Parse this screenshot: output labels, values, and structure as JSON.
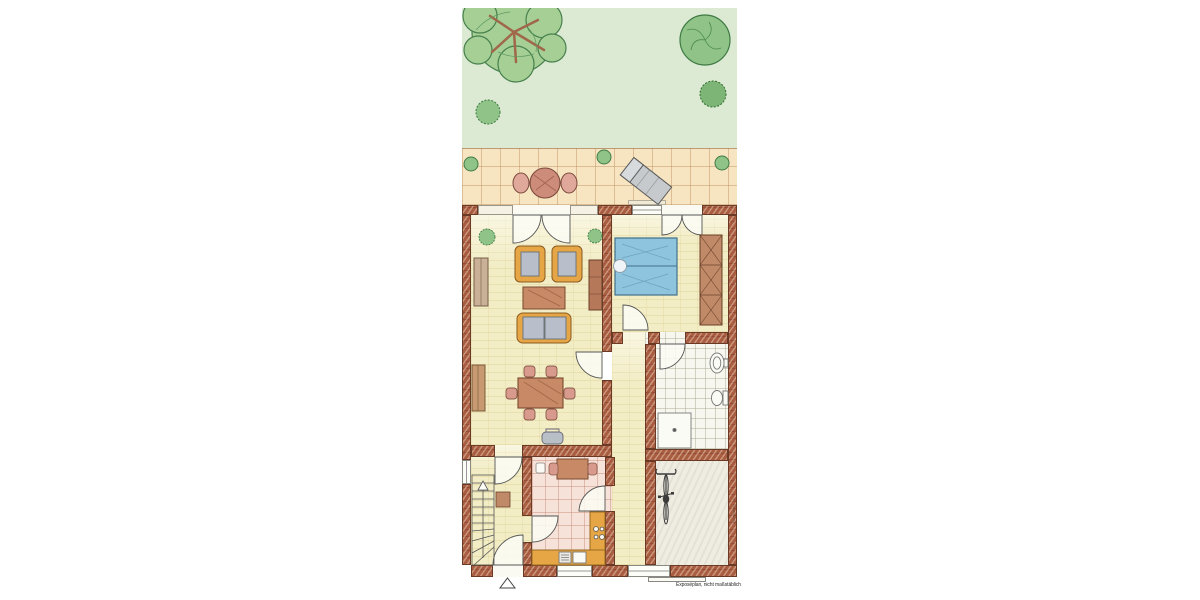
{
  "annotation": {
    "footer_note": "Exposéplan, nicht maßstäblich",
    "watermark": "© Grundriss"
  },
  "colors": {
    "wall_brick": "#a85c40",
    "floor_living": "#f2edc5",
    "floor_tile": "#f8f7ef",
    "floor_kitchen": "#f6e2d8",
    "floor_bike": "#efece2",
    "terrace": "#f7e5c2",
    "garden": "#dcead3",
    "bed_blue": "#8ec4de",
    "furniture_orange": "#e6a645",
    "furniture_wood": "#c88a66",
    "accent_green": "#8fc387"
  }
}
